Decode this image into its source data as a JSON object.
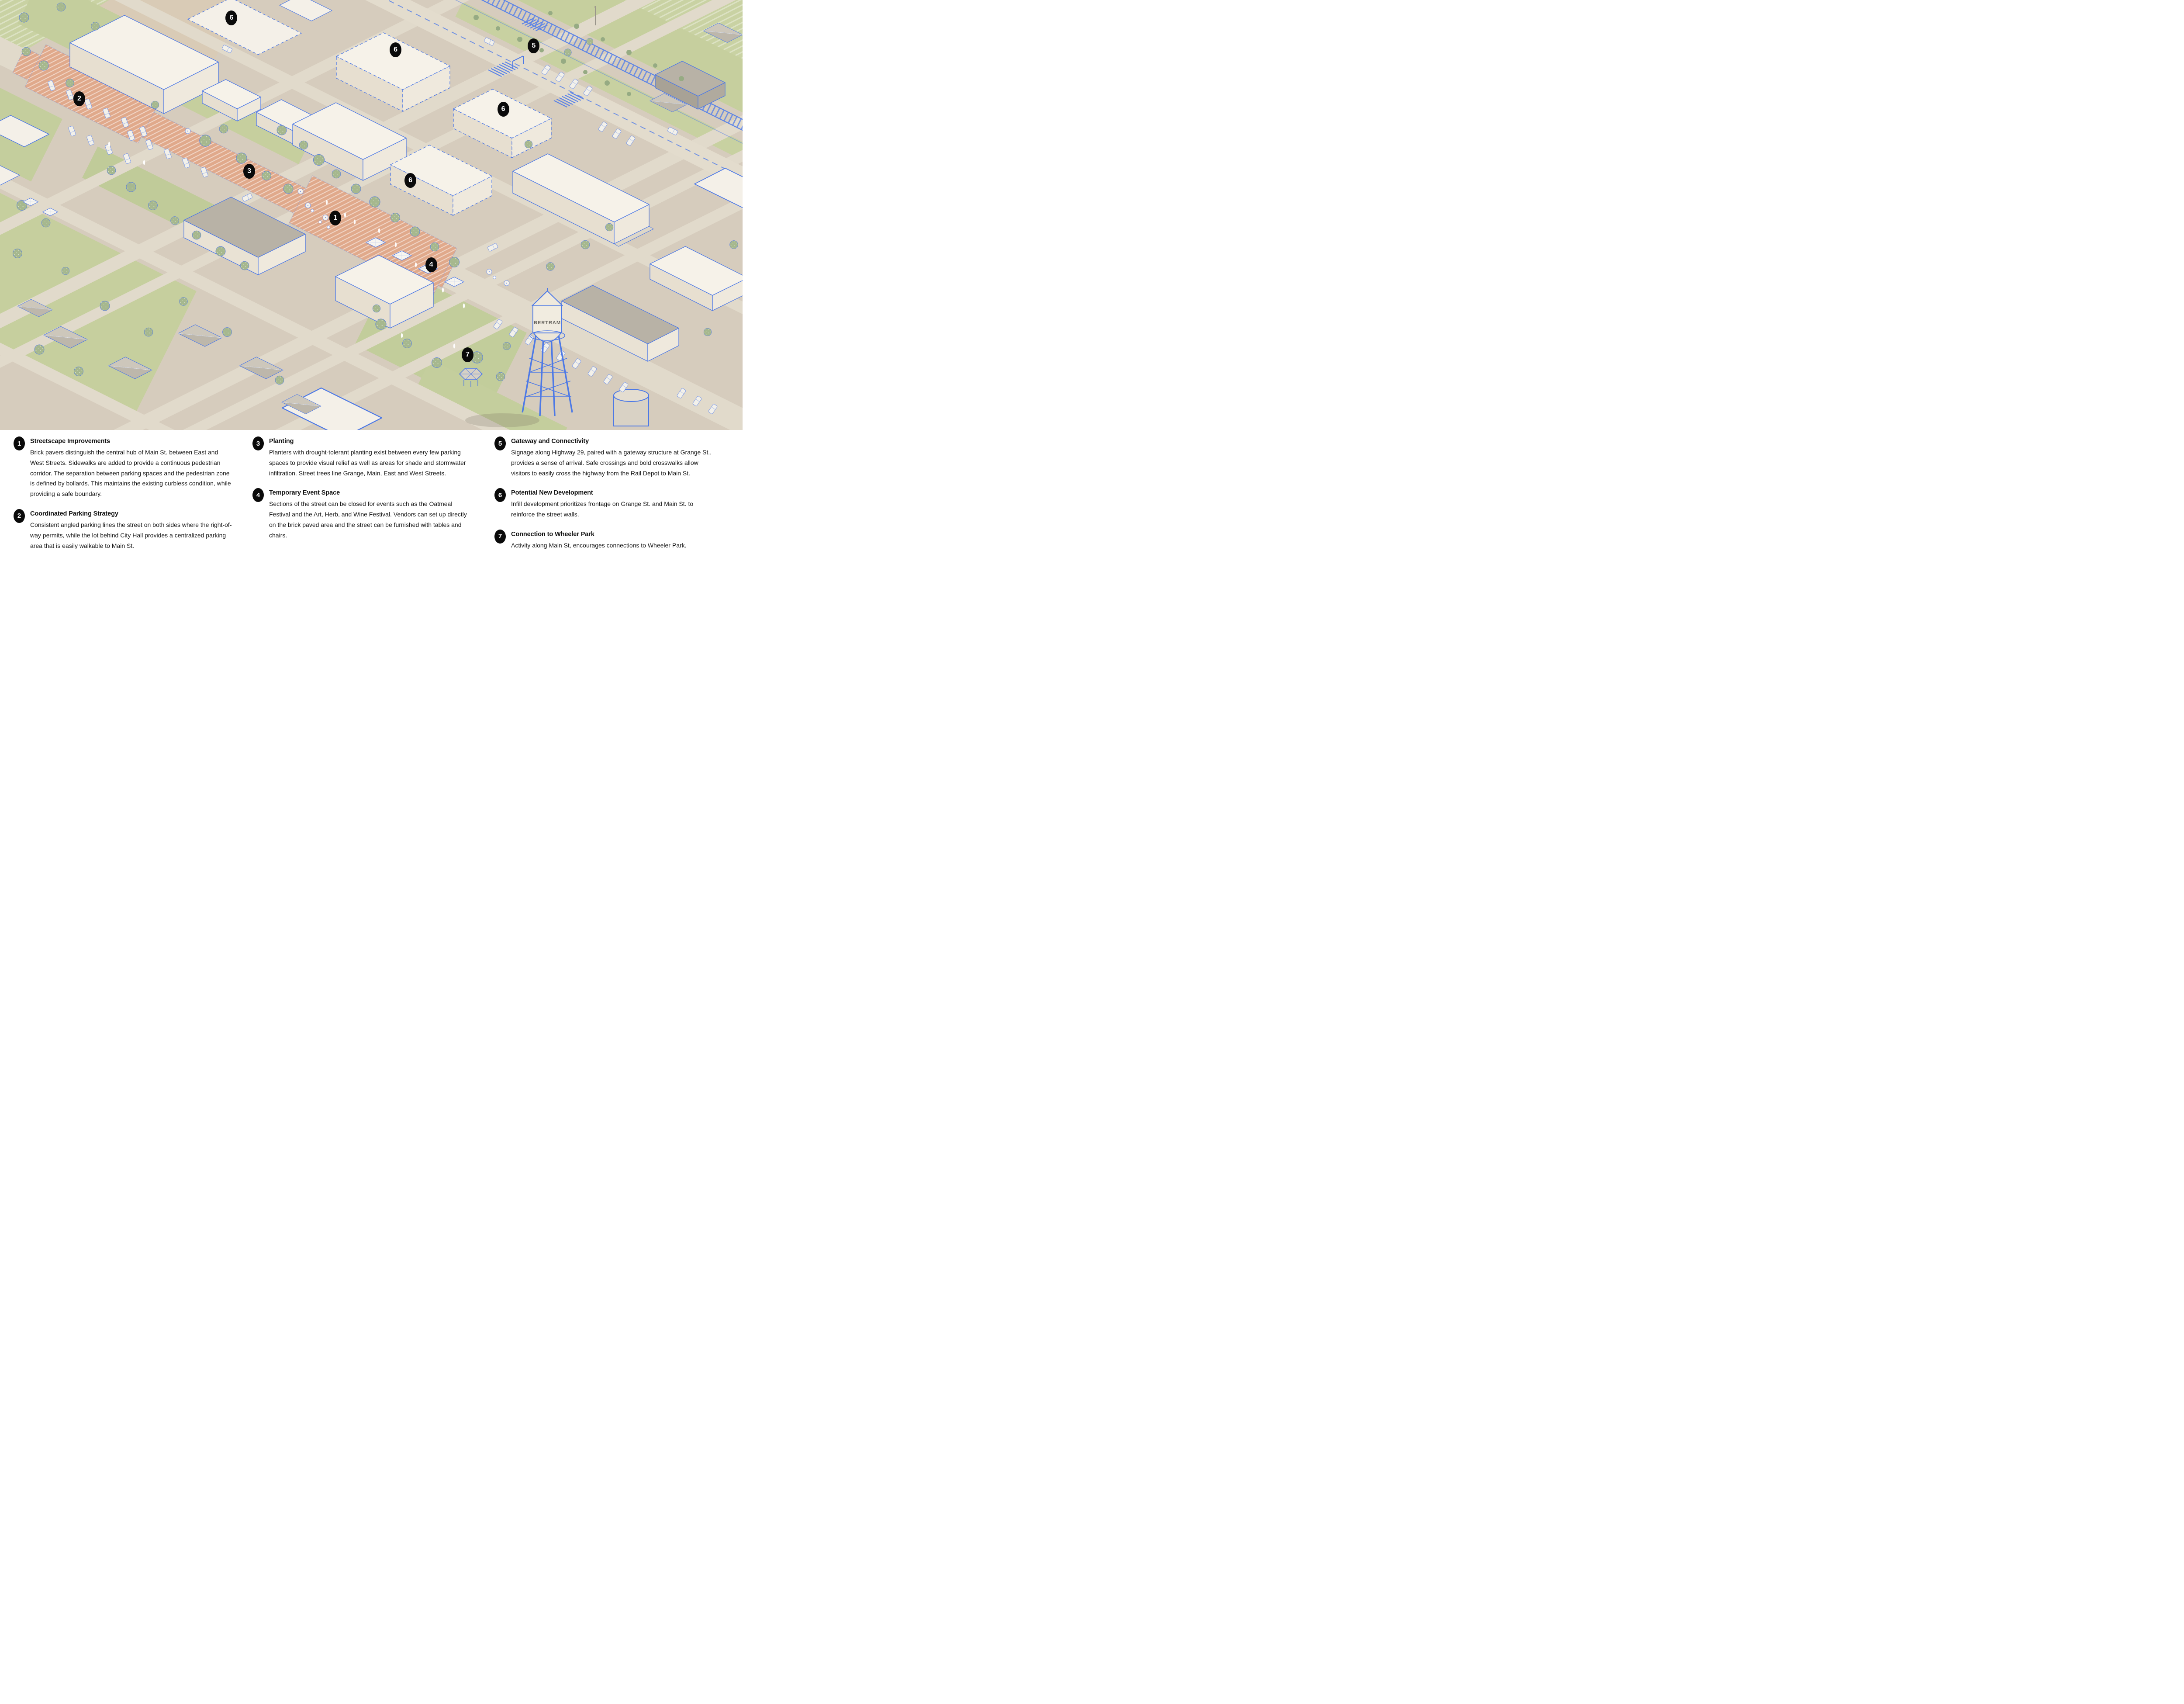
{
  "map": {
    "town_name": "BERTRAM",
    "colors": {
      "marker_background": "#0a0a0a",
      "marker_text": "#ffffff",
      "outline_blue": "#4d79e6",
      "brick_paving": "#e0a98b",
      "grass_green": "#c4ce9d",
      "road_beige": "#e1dacb",
      "block_tan": "#d6ccbd",
      "building_cream": "#f6f2e9",
      "tree_sage": "#a6b88e"
    },
    "markers": [
      {
        "label": "1",
        "x_pct": 45.2,
        "y_pct": 50.7
      },
      {
        "label": "2",
        "x_pct": 10.7,
        "y_pct": 23.0
      },
      {
        "label": "3",
        "x_pct": 33.6,
        "y_pct": 39.8
      },
      {
        "label": "4",
        "x_pct": 58.1,
        "y_pct": 61.6
      },
      {
        "label": "5",
        "x_pct": 71.9,
        "y_pct": 10.7
      },
      {
        "label": "6",
        "x_pct": 31.2,
        "y_pct": 4.2
      },
      {
        "label": "6",
        "x_pct": 53.3,
        "y_pct": 11.6
      },
      {
        "label": "6",
        "x_pct": 67.8,
        "y_pct": 25.4
      },
      {
        "label": "6",
        "x_pct": 55.3,
        "y_pct": 42.0
      },
      {
        "label": "7",
        "x_pct": 63.0,
        "y_pct": 82.5
      }
    ]
  },
  "legend": {
    "items": [
      {
        "number": "1",
        "title": "Streetscape Improvements",
        "body": "Brick pavers distinguish the central hub of Main St. between East and West Streets. Sidewalks are added to provide a continuous pedestrian corridor. The separation between parking spaces and the pedestrian zone is defined by bollards. This maintains the existing curbless condition, while providing a safe boundary.",
        "column": 1
      },
      {
        "number": "2",
        "title": "Coordinated Parking Strategy",
        "body": "Consistent angled parking lines the street on both sides where the right-of-way permits, while the lot behind City Hall provides a centralized parking area that is easily walkable to Main St.",
        "column": 1
      },
      {
        "number": "3",
        "title": "Planting",
        "body": "Planters with drought-tolerant planting exist between every few parking spaces to provide visual relief as well as areas for shade and stormwater infiltration. Street trees line Grange, Main, East and West Streets.",
        "column": 2
      },
      {
        "number": "4",
        "title": "Temporary Event Space",
        "body": "Sections of the street can be closed for events such as the Oatmeal Festival and the Art, Herb, and Wine Festival. Vendors can set up directly on the brick paved area and the street can be furnished with tables and chairs.",
        "column": 2
      },
      {
        "number": "5",
        "title": "Gateway and Connectivity",
        "body": "Signage along Highway 29, paired with a gateway structure at Grange St., provides a sense of arrival. Safe crossings and bold crosswalks allow visitors to easily cross the highway from the Rail Depot to Main St.",
        "column": 3
      },
      {
        "number": "6",
        "title": "Potential New Development",
        "body": "Infill development prioritizes frontage on Grange St. and Main St. to reinforce the street walls.",
        "column": 3
      },
      {
        "number": "7",
        "title": "Connection to Wheeler Park",
        "body": "Activity along Main St, encourages connections to Wheeler Park.",
        "column": 3
      }
    ]
  }
}
